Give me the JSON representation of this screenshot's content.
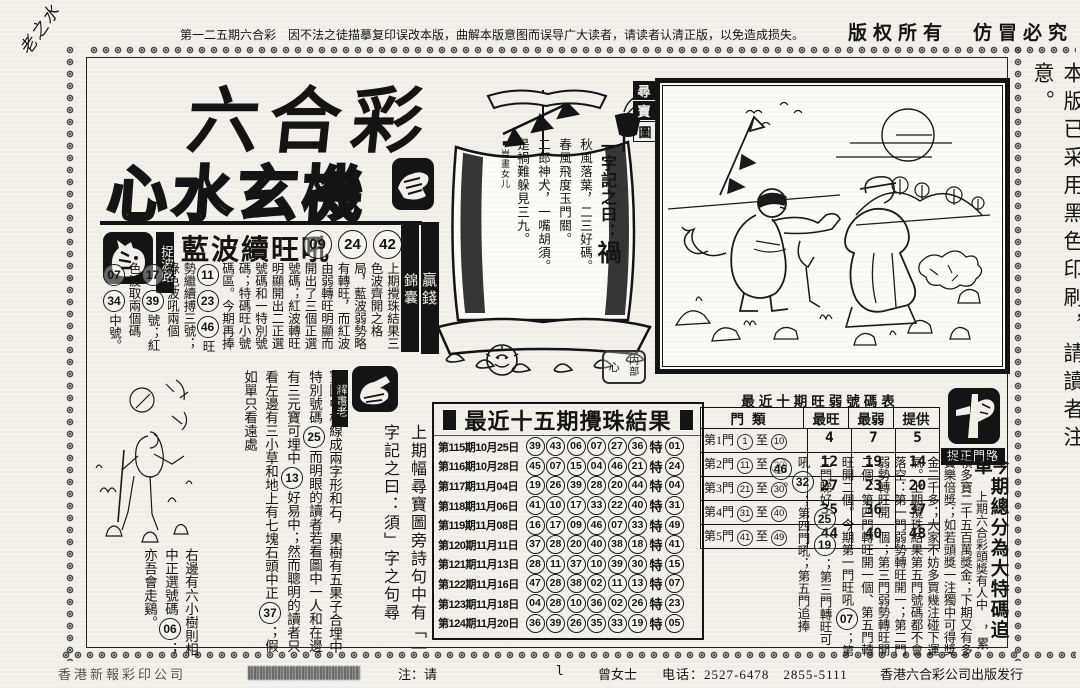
{
  "top_bar": {
    "corner_note": "老之水",
    "notice": "第一二五期六合彩　因不法之徒描摹复印误改本版，曲解本版意图而误导广大读者，请读者认清正版，以免造成损失。",
    "copyright": "版权所有　仿冒必究"
  },
  "masthead": {
    "title_line1": "六合彩",
    "title_line2": "心水玄機"
  },
  "right_margin_note": "本版已采用黑色印刷，請讀者注意。",
  "labels": {
    "win_money": "贏錢",
    "jin_nang": "錦囊"
  },
  "blue_wave": {
    "stamp_label": "捉波路",
    "headline": "藍波續旺吼",
    "numbers": [
      "09",
      "24",
      "42"
    ],
    "body_segments": [
      {
        "t": "上期攪珠結果三色波齊開之格局，藍波弱勢略有轉旺，而紅波由弱轉旺明顯而開出了三個正選號碼；紅波轉旺明顯開出二正選號碼和一特別號碼；特碼旺小號碼區。今期再捧"
      },
      {
        "n": "11"
      },
      {
        "n": "23"
      },
      {
        "n": "46"
      },
      {
        "t": "旺勢繼續搏三號；綠色波吼兩個"
      },
      {
        "n": "17"
      },
      {
        "n": "39"
      },
      {
        "t": "號；紅色波取兩個碼"
      },
      {
        "n": "07"
      },
      {
        "n": "34"
      },
      {
        "t": "中號。"
      }
    ]
  },
  "boat": {
    "treasure_seal": [
      "尋",
      "寶",
      "圖"
    ],
    "motto_prefix": "一字記之曰：",
    "motto_char": "禍",
    "poem": [
      "秋風落葉，二三好碼。",
      "春風飛度玉門關。",
      "二郎神犬，一嘴胡須。",
      "是禍難躲見三九。"
    ],
    "credit": "■豈畫女儿",
    "inner_seal": {
      "left": "心",
      "top_right": "内",
      "bottom_right": "部"
    }
  },
  "interpreter": {
    "stamp_label": "解畫老",
    "intro": "上期幅尋寶圖旁詩句中有「一字記之曰：須」字之句尋",
    "body_segments": [
      {
        "t": "寶圖中橫線成兩字形和石，果樹有五果子合埋中特別號碼"
      },
      {
        "n": "25"
      },
      {
        "t": "而明眼的讀者若看圖中一人和在邊有三元寶可埋中"
      },
      {
        "n": "13"
      },
      {
        "t": "好易中；然而聰明的讀者只看左邊有三小草和地上有七塊石頭中正"
      },
      {
        "n": "37"
      },
      {
        "t": "；假如單只看遠處"
      }
    ],
    "tail_segments": [
      {
        "t": "右邊有六小樹則相中正選號碼"
      },
      {
        "n": "06"
      },
      {
        "t": "；亦吾會走鷄。"
      }
    ]
  },
  "results_table": {
    "title": "最近十五期攪珠結果",
    "special_label": "特",
    "rows": [
      {
        "label": "第115期10月25日",
        "nums": [
          "39",
          "43",
          "06",
          "07",
          "27",
          "36"
        ],
        "special": "01"
      },
      {
        "label": "第116期10月28日",
        "nums": [
          "45",
          "07",
          "15",
          "04",
          "46",
          "21"
        ],
        "special": "24"
      },
      {
        "label": "第117期11月04日",
        "nums": [
          "19",
          "26",
          "39",
          "28",
          "20",
          "44"
        ],
        "special": "04"
      },
      {
        "label": "第118期11月06日",
        "nums": [
          "41",
          "10",
          "17",
          "33",
          "22",
          "40"
        ],
        "special": "31"
      },
      {
        "label": "第119期11月08日",
        "nums": [
          "16",
          "17",
          "09",
          "46",
          "07",
          "33"
        ],
        "special": "49"
      },
      {
        "label": "第120期11月11日",
        "nums": [
          "37",
          "28",
          "20",
          "40",
          "38",
          "18"
        ],
        "special": "41"
      },
      {
        "label": "第121期11月13日",
        "nums": [
          "28",
          "11",
          "37",
          "10",
          "39",
          "30"
        ],
        "special": "15"
      },
      {
        "label": "第122期11月16日",
        "nums": [
          "47",
          "28",
          "38",
          "02",
          "11",
          "13"
        ],
        "special": "07"
      },
      {
        "label": "第123期11月18日",
        "nums": [
          "04",
          "28",
          "10",
          "36",
          "02",
          "26"
        ],
        "special": "23"
      },
      {
        "label": "第124期11月20日",
        "nums": [
          "36",
          "39",
          "26",
          "35",
          "33",
          "19"
        ],
        "special": "05"
      }
    ]
  },
  "distribution_table": {
    "title": "最近十期旺弱號碼表",
    "class_header": "門類",
    "headers": [
      "最旺",
      "最弱",
      "提供"
    ],
    "to_label": "至",
    "rows": [
      {
        "gate": "第1門",
        "from": "1",
        "to": "10",
        "hot": "4",
        "cold": "7",
        "tip": "5"
      },
      {
        "gate": "第2門",
        "from": "11",
        "to": "20",
        "hot": "12",
        "cold": "19",
        "tip": "14"
      },
      {
        "gate": "第3門",
        "from": "21",
        "to": "30",
        "hot": "27",
        "cold": "23",
        "tip": "20"
      },
      {
        "gate": "第4門",
        "from": "31",
        "to": "40",
        "hot": "35",
        "cold": "36",
        "tip": "37"
      },
      {
        "gate": "第5門",
        "from": "41",
        "to": "49",
        "hot": "44",
        "cold": "40",
        "tip": "48"
      }
    ]
  },
  "gate_stamp_label": "捉正門路",
  "forecast": {
    "headline": "今期總分為大特碼追單",
    "subhead": "上期六合彩頭獎有人中",
    "body_segments": [
      {
        "t": "，累積多寶二千五百萬獎金；下期又有多寶樂倍獎；如若頭獎一注獨中可得獎金二千多；大家不妨多買幾注碰下運氣。上期攪珠結果第五門號碼都不會落空：第一門弱勢轉旺開一；第二門弱勢轉旺開一個；第三門弱勢轉旺開二個、第四門轉旺開一個、第五門轉旺開二個。今期第一門旺吼"
      },
      {
        "n": "07"
      },
      {
        "t": "；第二門睇好"
      },
      {
        "n": "25"
      },
      {
        "n": "19"
      },
      {
        "t": "；第三門轉旺可吼"
      },
      {
        "n": "32"
      },
      {
        "t": "；第四門吼；第五門追捧"
      },
      {
        "n": "46"
      },
      {
        "t": "。"
      }
    ]
  },
  "footer": {
    "printer": "香港新報彩印公司",
    "note": "注：请",
    "mark": "l",
    "contact": "曾女士",
    "phone": "电话：2527-6478　2855-5111",
    "publisher": "香港六合彩公司出版发行"
  }
}
